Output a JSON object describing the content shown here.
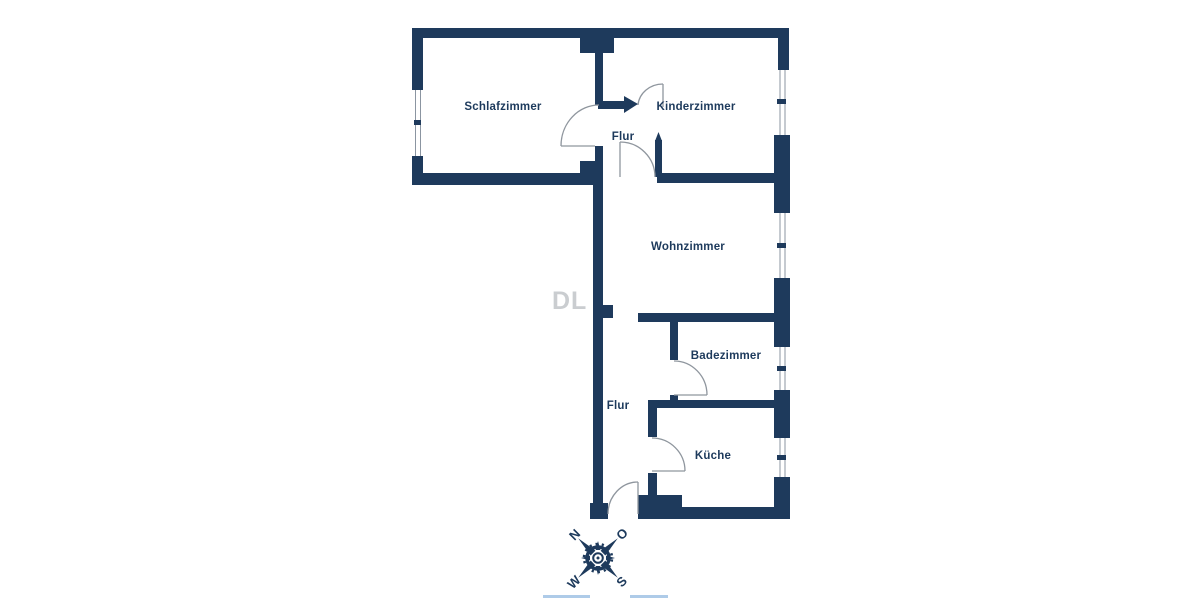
{
  "rooms": [
    {
      "id": "schlafzimmer",
      "label": "Schlafzimmer"
    },
    {
      "id": "kinderzimmer",
      "label": "Kinderzimmer"
    },
    {
      "id": "flur_oben",
      "label": "Flur"
    },
    {
      "id": "wohnzimmer",
      "label": "Wohnzimmer"
    },
    {
      "id": "badezimmer",
      "label": "Badezimmer"
    },
    {
      "id": "flur_unten",
      "label": "Flur"
    },
    {
      "id": "kueche",
      "label": "Küche"
    }
  ],
  "compass": {
    "n": "N",
    "o": "O",
    "s": "S",
    "w": "W"
  },
  "watermark": "DL",
  "colors": {
    "wall": "#1e3a5c",
    "label": "#1d3a5c",
    "door_arc": "#8f969e",
    "window_line": "#8b95a1",
    "accent_line": "#aecbe8",
    "watermark": "#c6c9cd"
  }
}
